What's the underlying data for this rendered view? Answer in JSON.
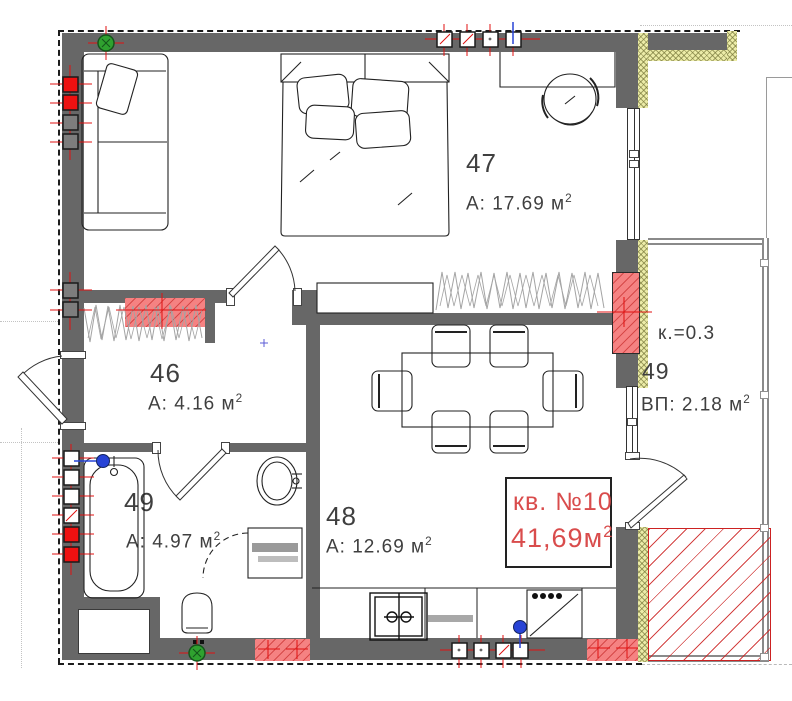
{
  "title": "План квартиры — кв. №10",
  "apartment_label": {
    "line1": "кв. №10",
    "line2": "41,69м",
    "sup": "2"
  },
  "rooms": {
    "r47": {
      "number": "47",
      "area": "А: 17.69 м",
      "sup": "2"
    },
    "r46": {
      "number": "46",
      "area": "А: 4.16 м",
      "sup": "2"
    },
    "r49": {
      "number": "49",
      "area": "А: 4.97 м",
      "sup": "2"
    },
    "r48": {
      "number": "48",
      "area": "А: 12.69 м",
      "sup": "2"
    },
    "balcony": {
      "coef": "к.=0.3",
      "number": "49",
      "area": "ВП: 2.18 м",
      "sup": "2"
    }
  },
  "colors": {
    "wall": "#676767",
    "insulation": "#ececa8",
    "radiator_fill": "#f58282",
    "hatch_red": "#cc2222",
    "label_red": "#d94c4c",
    "marker_red": "#ee1111",
    "marker_green": "#2fa12f",
    "marker_blue": "#2743d6"
  }
}
